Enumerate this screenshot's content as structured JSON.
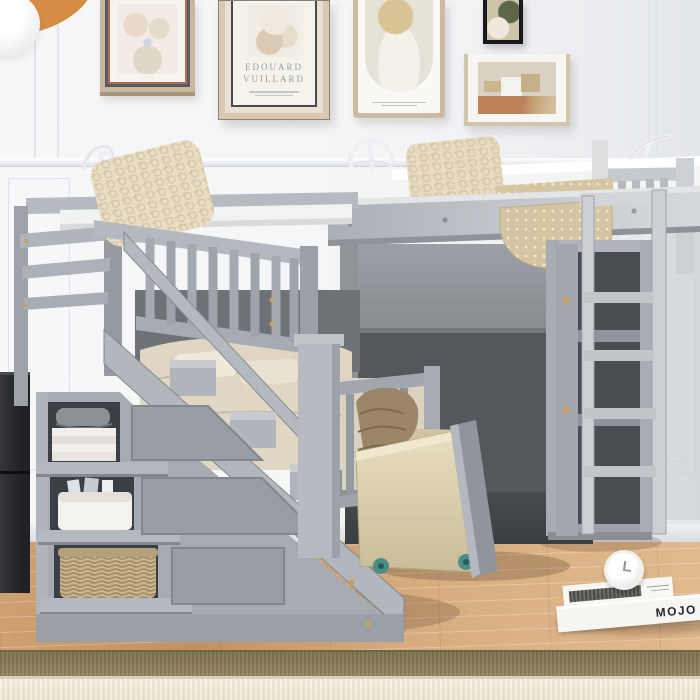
{
  "meta": {
    "type": "product-lifestyle-photo",
    "subject": "Gray twin L-shaped loft / bunk bed with storage staircase, bookshelf ladder and rolling under-bed drawer in a styled bedroom",
    "finish_color_name": "Gray",
    "palette": {
      "bed_gray_light": "#b7bcc2",
      "bed_gray_mid": "#a3a8ae",
      "bed_gray_dark": "#55595e",
      "wall_white": "#f4f5f7",
      "floor_wood": "#cfa173",
      "rug_border_tan": "#8b7f5c",
      "rug_field_cream": "#ebe3d2",
      "drawer_wood": "#ddd3b4",
      "pillow_cream": "#e9ddc4",
      "blanket_beige": "#d8c8a6"
    }
  },
  "wall": {
    "art": {
      "poster_artist_line1": "EDOUARD",
      "poster_artist_line2": "VUILLARD"
    },
    "frames": [
      "square-floral-print",
      "vuillard-exhibition-poster",
      "arched-portrait-print",
      "small-dark-framed-art",
      "farmhouse-landscape-print"
    ],
    "ornaments": "white plaster scroll flourishes on chair-rail molding"
  },
  "floor_items": {
    "book_spine_title": "MOJO",
    "items": [
      "stack-of-white-books",
      "white-alarm-clock"
    ]
  },
  "bed_items": [
    "upper-bunk-with-guard-rail",
    "lower-bunk",
    "loft-bed-mattress",
    "storage-staircase-with-three-cubbies",
    "stair-handrail",
    "bookshelf-with-ladder",
    "rolling-underbed-drawer",
    "crochet-pillow-left",
    "crochet-pillow-right",
    "patterned-throw-blanket",
    "folded-linens",
    "gray-hat",
    "fabric-storage-bin",
    "magazines",
    "wicker-basket",
    "vinyl-records",
    "knit-cushion",
    "dark-side-cabinet",
    "pendant-lamp"
  ]
}
